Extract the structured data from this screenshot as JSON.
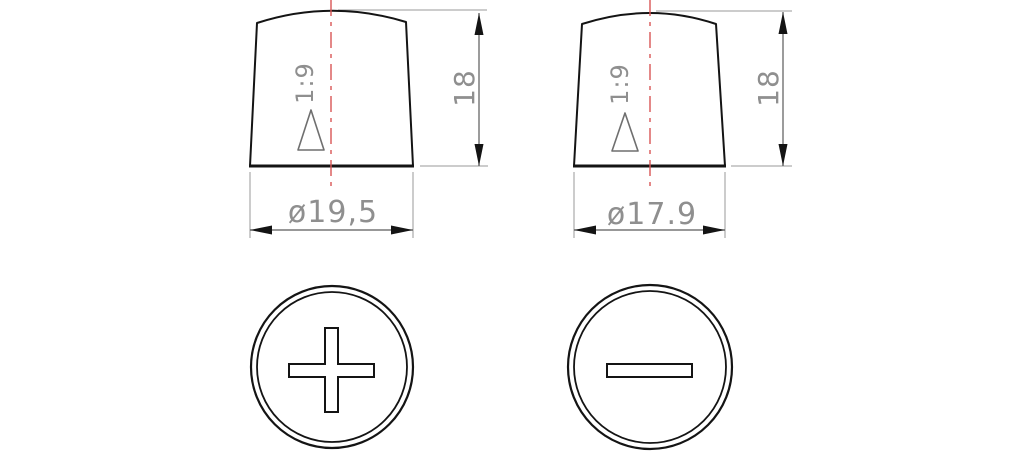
{
  "drawing": {
    "title": "battery-terminal-posts-technical-drawing",
    "colors": {
      "object_line": "#141414",
      "dimension_line": "#5a5a5a",
      "extension_line": "#9a9a9a",
      "text": "#8f8f8f",
      "centerline": "#d85555",
      "background": "#ffffff"
    },
    "positive_post": {
      "taper_label": "1:9",
      "height_label": "18",
      "diameter_label": "ø19,5",
      "polarity": "plus"
    },
    "negative_post": {
      "taper_label": "1:9",
      "height_label": "18",
      "diameter_label": "ø17.9",
      "polarity": "minus"
    }
  }
}
